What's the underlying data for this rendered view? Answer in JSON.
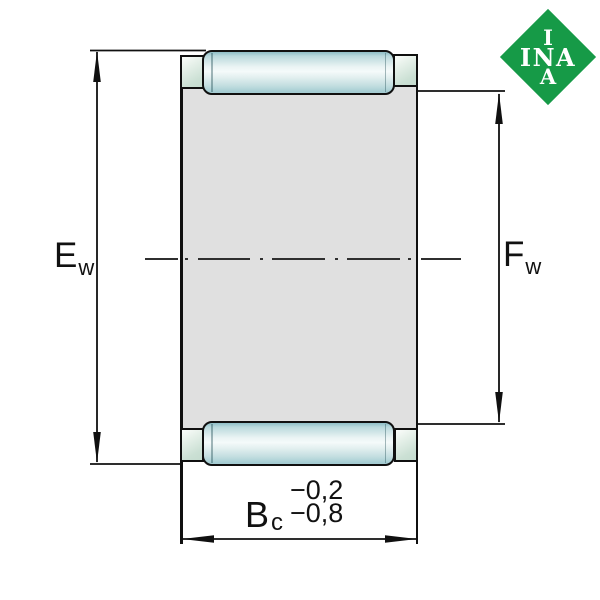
{
  "diagram": {
    "labels": {
      "outer_dim": {
        "base": "E",
        "sub": "w"
      },
      "inner_dim": {
        "base": "F",
        "sub": "w"
      },
      "width_dim": {
        "base": "B",
        "sub": "c",
        "tol_upper": "−0,2",
        "tol_lower": "−0,8"
      }
    },
    "logo": {
      "line1": "I",
      "line2": "INA",
      "line3": "A"
    },
    "colors": {
      "logo_green": "#169a47",
      "body_fill": "#e0e0e0",
      "roller_teal": "#a5ccd2",
      "cage_green": "#cbe0d4",
      "line": "#101010"
    }
  }
}
